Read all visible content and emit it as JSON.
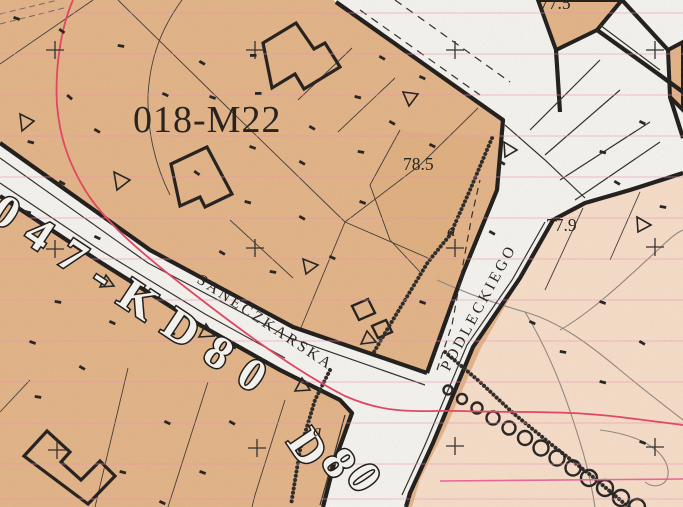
{
  "map": {
    "zone_code": "018-M22",
    "roads": {
      "code_full": "047-KD80",
      "code_partial": "D80",
      "street_1": "SANECZKARSKA",
      "street_2": "PODLECKIEGO"
    },
    "elevation_points": {
      "pt1": "78.5",
      "pt2": "77.9",
      "pt3": "77.5"
    },
    "sub_area_labels": {
      "a1": "a",
      "a2": "a"
    },
    "symbols": [
      "survey-cross-icon",
      "boundary-triangle-icon",
      "tree-row-circles-icon",
      "fence-bead-chain-icon"
    ],
    "colors": {
      "zone_orange": "#e2b183",
      "zone_peach": "#f6dcc6",
      "road_white": "#f5f3ee",
      "line_black": "#171412",
      "grid_pink": "#ef8fb3",
      "utility_red": "#e43d5c"
    }
  }
}
